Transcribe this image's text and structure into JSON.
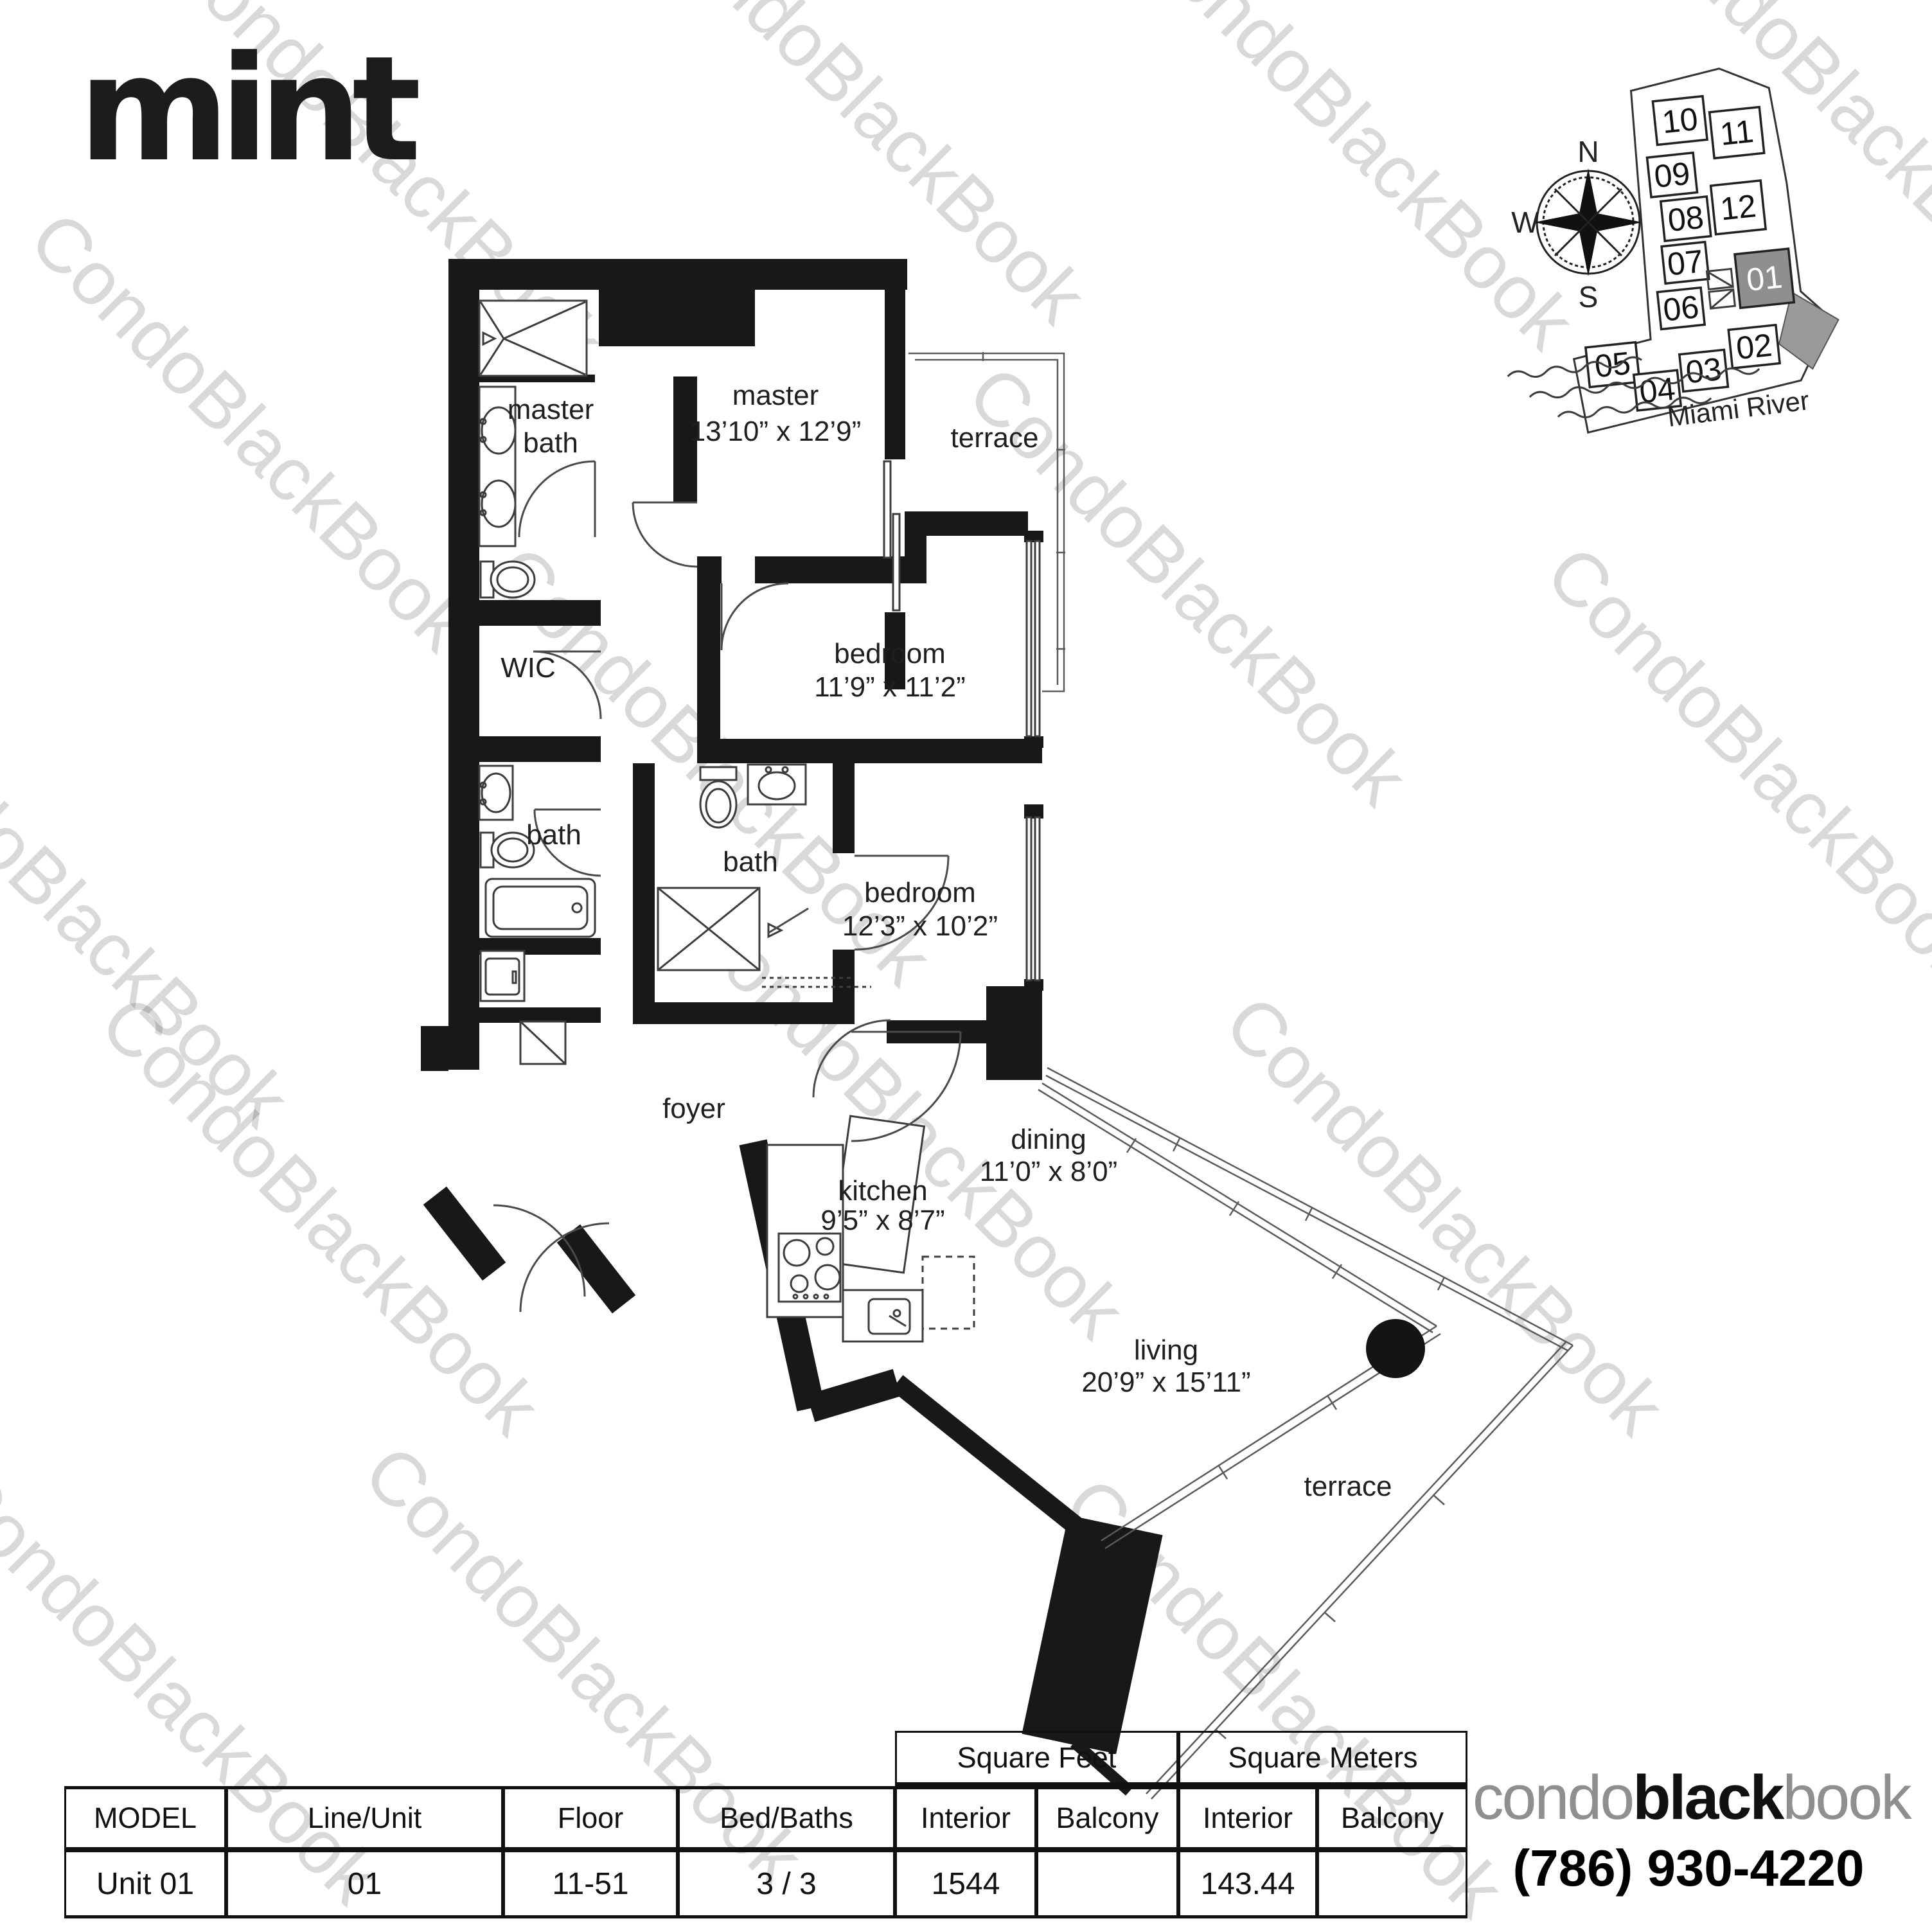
{
  "brand": {
    "building_logo": "mint"
  },
  "watermark": {
    "text": "CondoBlackBook"
  },
  "keyplan": {
    "compass": {
      "north": "N",
      "west": "W",
      "east": "E",
      "south": "S"
    },
    "river_label": "Miami River",
    "highlighted_unit": "01",
    "units": [
      "10",
      "11",
      "09",
      "08",
      "12",
      "07",
      "06",
      "01",
      "05",
      "04",
      "03",
      "02"
    ]
  },
  "floorplan": {
    "rooms": [
      {
        "name": "master-bath",
        "line1": "master",
        "line2": "bath"
      },
      {
        "name": "master-bedroom",
        "line1": "master",
        "line2": "13’10” x 12’9”"
      },
      {
        "name": "terrace-top",
        "line1": "terrace",
        "line2": ""
      },
      {
        "name": "wic",
        "line1": "WIC",
        "line2": ""
      },
      {
        "name": "bedroom-a",
        "line1": "bedroom",
        "line2": "11’9” x 11’2”"
      },
      {
        "name": "bath-a",
        "line1": "bath",
        "line2": ""
      },
      {
        "name": "bath-b",
        "line1": "bath",
        "line2": ""
      },
      {
        "name": "bedroom-b",
        "line1": "bedroom",
        "line2": "12’3” x 10’2”"
      },
      {
        "name": "foyer",
        "line1": "foyer",
        "line2": ""
      },
      {
        "name": "kitchen",
        "line1": "kitchen",
        "line2": "9’5” x 8’7”"
      },
      {
        "name": "dining",
        "line1": "dining",
        "line2": "11’0” x 8’0”"
      },
      {
        "name": "living",
        "line1": "living",
        "line2": "20’9” x 15’11”"
      },
      {
        "name": "terrace-bottom",
        "line1": "terrace",
        "line2": ""
      }
    ]
  },
  "table": {
    "section_headers": {
      "square_feet": "Square Feet",
      "square_meters": "Square Meters"
    },
    "columns": [
      "MODEL",
      "Line/Unit",
      "Floor",
      "Bed/Baths",
      "Interior",
      "Balcony",
      "Interior",
      "Balcony"
    ],
    "row": {
      "model": "Unit 01",
      "line_unit": "01",
      "floor": "11-51",
      "bed_baths": "3 / 3",
      "sf_interior": "1544",
      "sf_balcony": "",
      "sm_interior": "143.44",
      "sm_balcony": ""
    }
  },
  "footer": {
    "brand_condo": "condo",
    "brand_black": "black",
    "brand_book": "book",
    "phone": "(786) 930-4220"
  },
  "colors": {
    "wall": "#181818",
    "ink": "#111111",
    "watermark_gray": "#c9c9c9",
    "highlight_unit_fill": "#8f8f8f",
    "logo_gray": "#8f8f8f"
  }
}
